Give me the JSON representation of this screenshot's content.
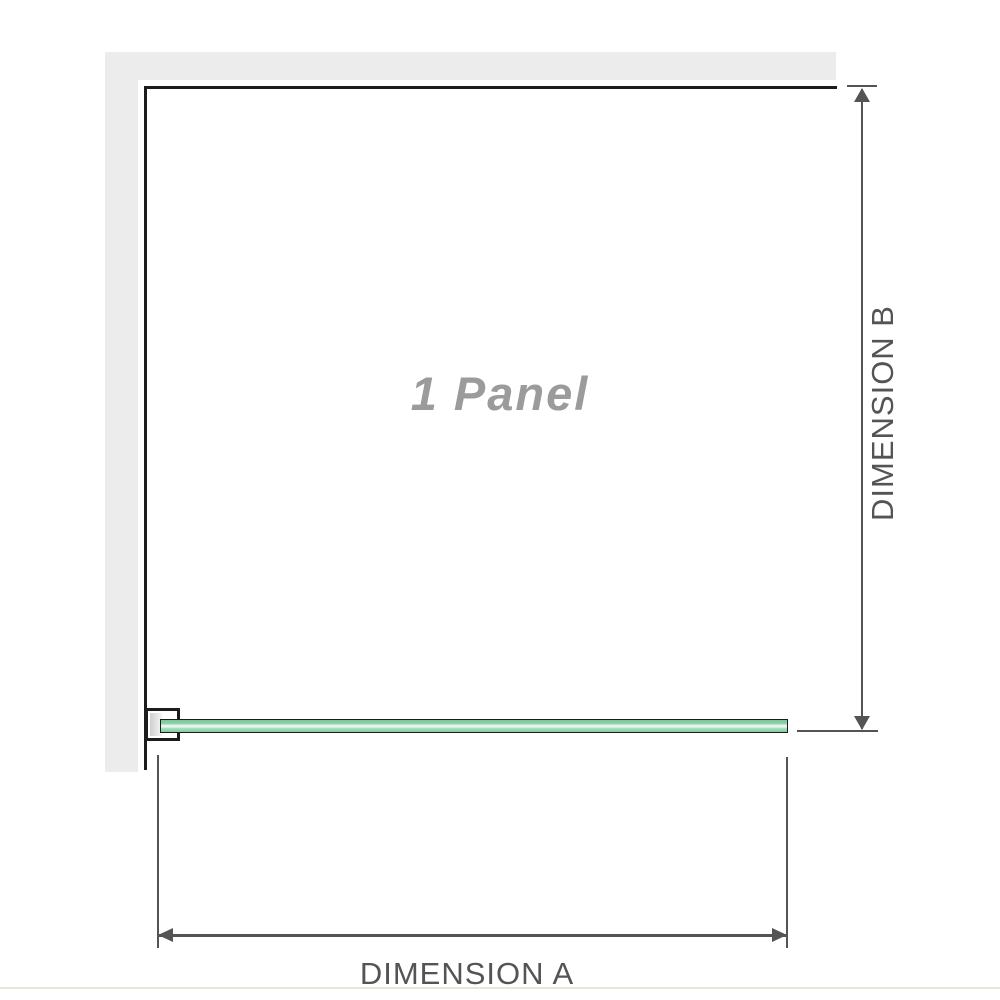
{
  "diagram": {
    "panel_label": "1 Panel",
    "dimension_a": {
      "label": "DIMENSION A"
    },
    "dimension_b": {
      "label": "DIMENSION B"
    }
  },
  "colors": {
    "wall": "#ececec",
    "outline": "#1c1c1c",
    "dimension": "#545454",
    "glass_green": "#8ed2ab",
    "glass_highlight": "#e9f8ef",
    "panel_label_text": "#9b9b9b",
    "footer_line": "#e9e5da"
  }
}
